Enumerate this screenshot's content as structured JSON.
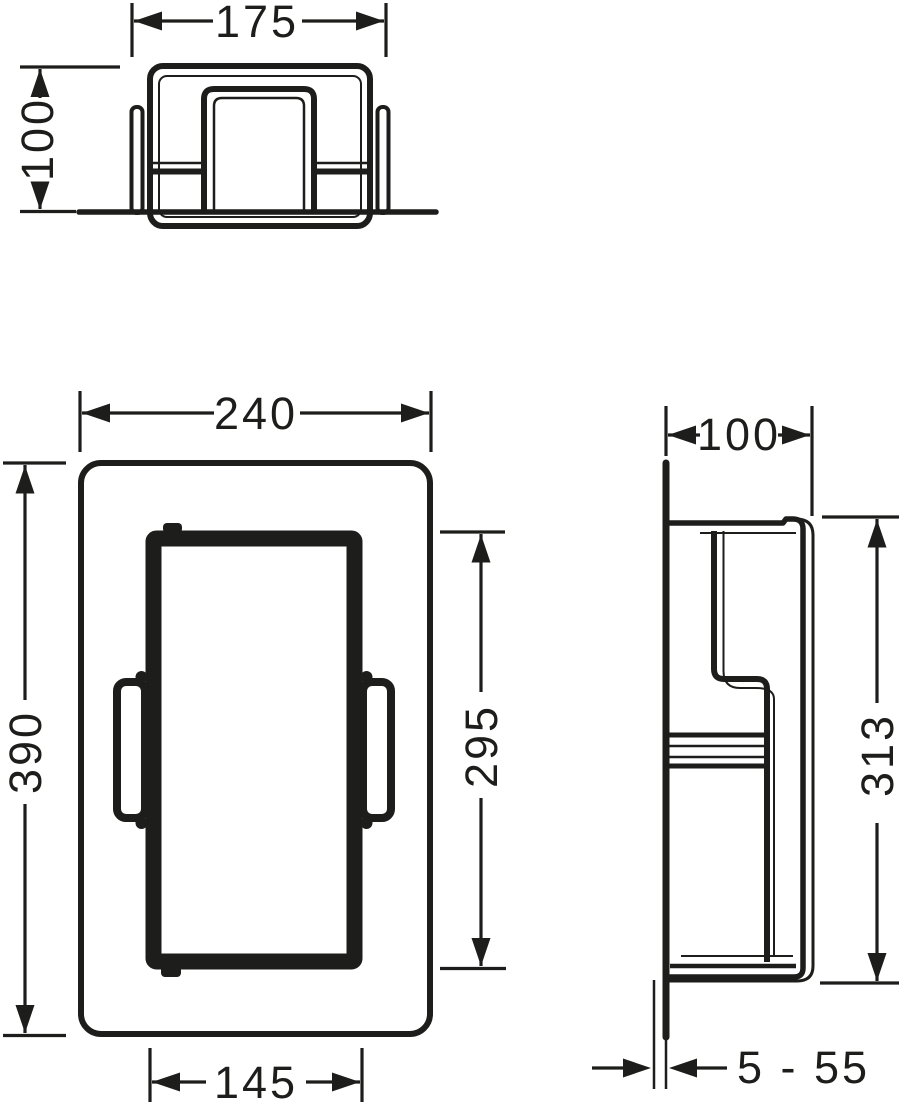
{
  "document_type": "technical-dimension-drawing",
  "colors": {
    "line": "#1d1d1b",
    "background": "#ffffff"
  },
  "views": {
    "top": {
      "dims": {
        "width": {
          "label": "175"
        },
        "height": {
          "label": "100"
        }
      }
    },
    "front": {
      "dims": {
        "outer_width": {
          "label": "240"
        },
        "outer_height": {
          "label": "390"
        },
        "opening_height": {
          "label": "295"
        },
        "opening_width": {
          "label": "145"
        }
      }
    },
    "side": {
      "dims": {
        "depth": {
          "label": "100"
        },
        "body_height": {
          "label": "313"
        },
        "tile_range": {
          "label": "5 - 55"
        }
      }
    }
  }
}
